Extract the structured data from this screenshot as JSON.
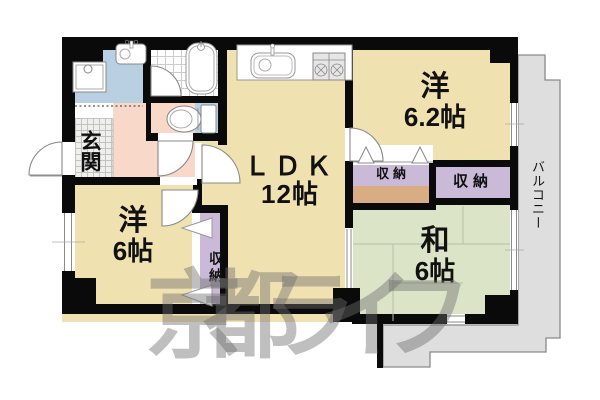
{
  "watermark": "京都ライフ",
  "rooms": {
    "ldk": {
      "label": "ＬＤＫ",
      "size": "12帖"
    },
    "western62": {
      "label": "洋",
      "size": "6.2帖"
    },
    "western6": {
      "label": "洋",
      "size": "6帖"
    },
    "japanese6": {
      "label": "和",
      "size": "6帖"
    },
    "entrance": {
      "label": "玄関"
    },
    "balcony": {
      "label": "バルコニー"
    },
    "closetTop": {
      "label": "収納"
    },
    "closetRight": {
      "label": "収納"
    },
    "closetWest": {
      "label": "収納"
    }
  },
  "colors": {
    "flooring": "#f0e1b0",
    "hallway": "#f8d8c8",
    "wetArea": "#b9cfe2",
    "closet": "#cabad8",
    "board": "#d8ad83",
    "tatami": "#dce4c8",
    "balcony": "#dedede",
    "wall": "#0a0a0a"
  }
}
